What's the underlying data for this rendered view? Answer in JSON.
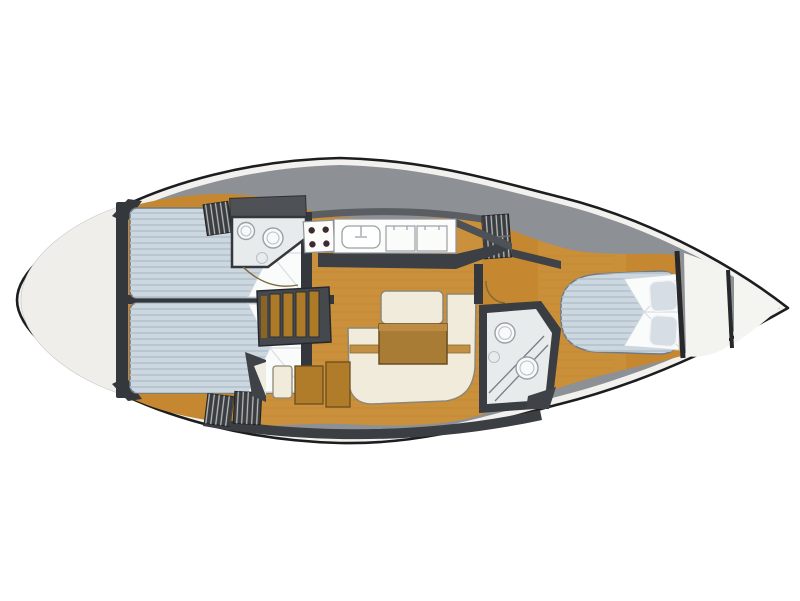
{
  "plan": {
    "type": "sailboat-interior-layout-plan",
    "view": "top-down, bow pointing right, no visible text labels"
  },
  "colors": {
    "background": "#ffffff",
    "hull_outline": "#1b1d1f",
    "hull_fill": "#f2f1ed",
    "deck_gray": "#8d9196",
    "deck_dark_band": "#3b3e42",
    "coaming_dark": "#5a5e63",
    "stern_platform": "#efeeea",
    "wood": "#c5872f",
    "wood_light_floor": "#d09a48",
    "wood_cabinet": "#b07c2a",
    "plank_line": "#b8822e",
    "wall_dark": "#34373b",
    "locker_face": "#3a3d41",
    "locker_hatch_line": "#b9bbb8",
    "mattress": "#ccd7e0",
    "mattress_stripe": "#b6c4d0",
    "linen_white": "#fafbfb",
    "pillow": "#d6dde4",
    "sofa_cream": "#f0ebda",
    "table_brown": "#a97c35",
    "table_trim": "#c29045",
    "counter_white": "#fcfcfa",
    "stove_burner": "#3e2b31",
    "fixture_white": "#f8f9f9",
    "head_floor": "#e8ebec",
    "storage_gray": "#4e5257",
    "stairs_wood": "#ad7a27",
    "stairs_frame": "#45494e",
    "bow_white": "#f4f4f1",
    "anchor_locker_white": "#f3f3ef"
  },
  "regions": {
    "stern_platform": "rounded stern swim platform",
    "aft_cabin_port": "aft double-berth cabin (top)",
    "aft_cabin_starboard": "aft double-berth cabin (bottom)",
    "head_port": "head with toilet and washbasin (top, beside galley)",
    "galley": "galley with stove, sink and two top-loading lockers",
    "companionway": "companionway steps",
    "salon": "salon with U-shaped settee, bench and table",
    "head_starboard": "head with toilet, washbasin and shower (bottom right)",
    "nav_area": "locker and doorway area forward of galley",
    "forward_cabin": "forward cabin with V-berth and pillows",
    "anchor_locker": "bow anchor locker",
    "bow": "bow tip"
  }
}
